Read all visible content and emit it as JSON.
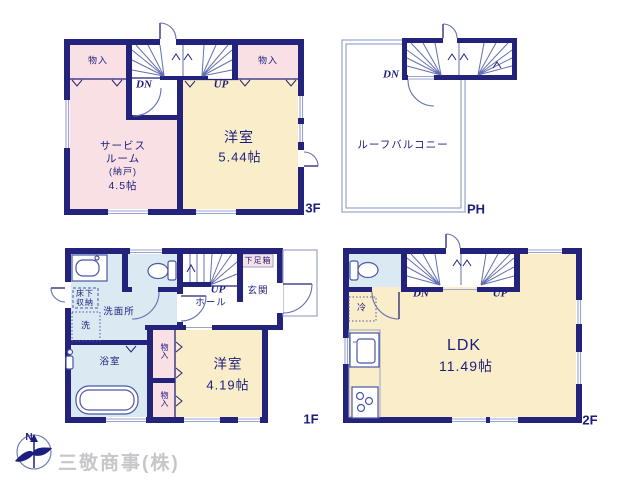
{
  "floors": {
    "f3": {
      "name": "3F",
      "closet_left": "物入",
      "closet_right": "物入",
      "dn": "DN",
      "up": "UP",
      "room1_line1": "洋室",
      "room1_line2": "5.44帖",
      "room2_line1": "サービス",
      "room2_line2": "ルーム",
      "room2_line3": "(納戸)",
      "room2_line4": "4.5帖"
    },
    "ph": {
      "name": "PH",
      "dn": "DN",
      "balcony": "ルーフバルコニー"
    },
    "f1": {
      "name": "1F",
      "up": "UP",
      "hall": "ホール",
      "entrance": "玄関",
      "shoe_box": "下足箱",
      "washroom": "洗面所",
      "underfloor_line1": "床下",
      "underfloor_line2": "収納",
      "washer": "洗",
      "bathroom": "浴室",
      "closet_upper": "物入",
      "closet_lower": "物入",
      "room1_line1": "洋室",
      "room1_line2": "4.19帖"
    },
    "f2": {
      "name": "2F",
      "dn": "DN",
      "up": "UP",
      "fridge": "冷",
      "ldk_line1": "LDK",
      "ldk_line2": "11.49帖"
    }
  },
  "compass": {
    "north_label": "N"
  },
  "watermark": "三敬商事(株)",
  "colors": {
    "wall": "#23237b",
    "room_pink": "#f8e0e4",
    "room_beige": "#faedca",
    "room_blue": "#dbe9f2",
    "line": "#9aa3cc",
    "text": "#1c1e7d",
    "watermark": "#c6c6cb"
  }
}
